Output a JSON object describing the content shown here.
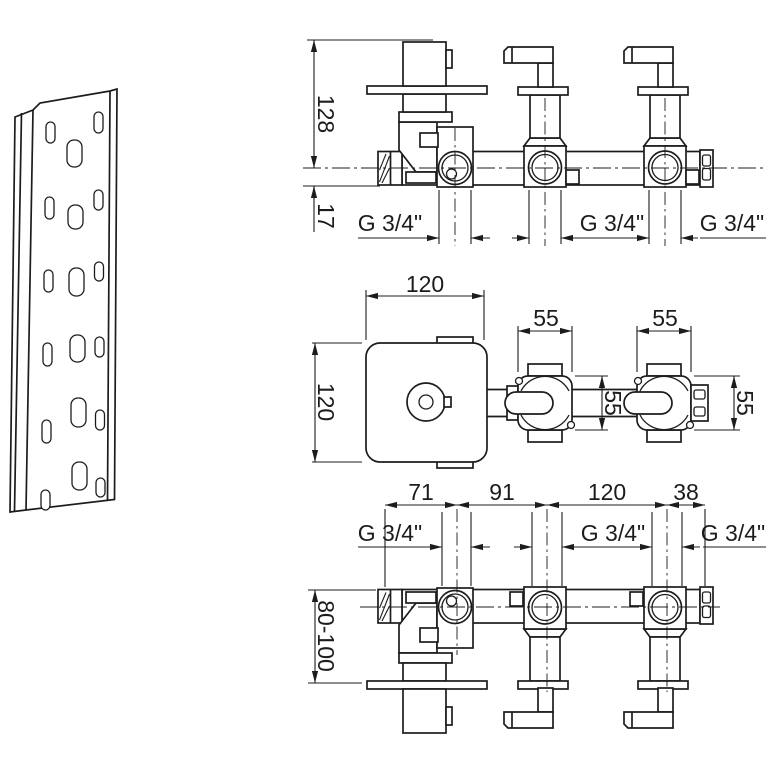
{
  "colors": {
    "line": "#1c1c1c",
    "background": "#ffffff"
  },
  "front_view": {
    "dim_height": "128",
    "dim_center_offset": "17",
    "threads": [
      "G 3/4\"",
      "G 3/4\"",
      "G 3/4\""
    ]
  },
  "plan_view": {
    "dim_plate_w": "120",
    "dim_plate_h": "120",
    "dim_valve_w_1": "55",
    "dim_valve_w_2": "55",
    "dim_valve_d_mid": "55",
    "dim_valve_d_right": "55"
  },
  "back_view": {
    "dim_seg_1": "71",
    "dim_seg_2": "91",
    "dim_seg_3": "120",
    "dim_seg_4": "38",
    "threads": [
      "G 3/4\"",
      "G 3/4\"",
      "G 3/4\""
    ],
    "dim_depth": "80-100"
  }
}
